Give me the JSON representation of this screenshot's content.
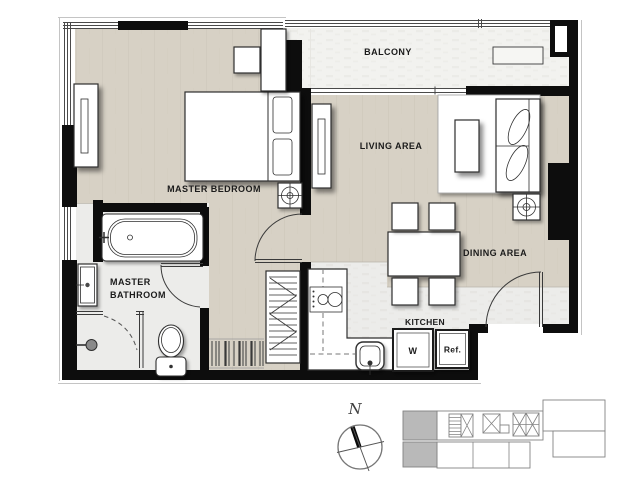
{
  "plan": {
    "rooms": {
      "balcony": "BALCONY",
      "master_bedroom": "MASTER BEDROOM",
      "living_area": "LIVING AREA",
      "dining_area": "DINING AREA",
      "master_bathroom_line1": "MASTER",
      "master_bathroom_line2": "BATHROOM",
      "kitchen": "KITCHEN"
    },
    "appliances": {
      "washer": "W",
      "refrigerator": "Ref."
    },
    "compass": {
      "north": "N"
    },
    "colors": {
      "floor_beige": "#d7d1c5",
      "floor_light": "#ececea",
      "floor_balcony": "#f2f2ef",
      "wall": "#0d0d0d",
      "keyplan_highlight": "#b9b9b9"
    }
  }
}
